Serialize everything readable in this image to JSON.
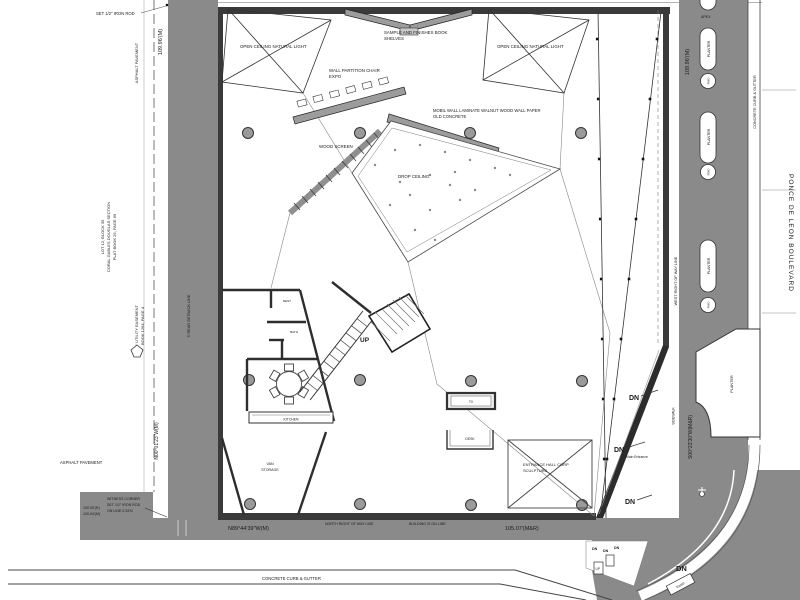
{
  "colors": {
    "paving_gray": "#8a8a8a",
    "wall_dark": "#3a3a3a",
    "wood_gray": "#9c9c9c",
    "line_gray": "#555555",
    "paper_white": "#ffffff"
  },
  "site_west": {
    "iron_rod_note": "SET 1/2\" IRON ROD",
    "dim_north_west": "109.96'(M)",
    "asphalt_vertical": "ASPHALT PAVEMENT",
    "lot_l1": "LOT 12, BLOCK 35",
    "lot_l2": "CORAL GABLES DOUGLAS SECTION",
    "lot_l3": "PLAT BOOK 25, PAGE 69",
    "easement_l1": "5' UTILITY EASEMENT",
    "easement_l2": "BOOK 1264, PAGE 4",
    "rear_setback": "5' REAR SETBACK LINE",
    "asphalt_horizontal": "ASPHALT PAVEMENT",
    "bearing_west": "N00°01'23\"W(M)",
    "witness_l1": "WITNESS CORNER",
    "witness_l2": "SET 1/2\" IRON ROD",
    "witness_l3": "ON LINE 0.33'N",
    "dim_record": "100.00'(R)",
    "dim_measured": "100.04'(M)"
  },
  "site_south": {
    "bearing_south": "N89°44'39\"W(M)",
    "row_line": "NORTH RIGHT OF WAY LINE",
    "building_on_line": "BUILDING IS ON LINE",
    "dim_south": "105.07'(M&R)",
    "curb": "CONCRETE CURB & GUTTER"
  },
  "site_east": {
    "dim_north_east": "109.96'(M)",
    "curb_vertical": "CONCRETE CURB & GUTTER",
    "west_row_line": "WEST RIGHT OF WAY LINE",
    "bearing_east": "S00°23'30\"W(M&R)",
    "sidewalk": "SIDEWALK",
    "street_name": "PONCE DE LEON BOULEVARD",
    "planter_label": "PLANTER",
    "tree_label": "PINO",
    "apex_label": "APEX",
    "dn": "DN",
    "ramp": "RAMP",
    "main_entrance": "Main Entrance",
    "stair_up": "UP"
  },
  "plan": {
    "shelves_l1": "SAMPLE AND FINISHES BOOK",
    "shelves_l2": "SHELVES",
    "open_ceiling": "OPEN CEILING NATURAL LIGHT",
    "partition_l1": "WALL PARTITION CHAIR",
    "partition_l2": "EXPO",
    "mobil_l1": "MOBIL WALL LAMINATE WALNUT WOOD WALL PAPER",
    "mobil_l2": "OLD CONCRETE",
    "wood_screen": "WOOD SCREEN",
    "drop_ceiling": "DROP CEILING",
    "up": "UP",
    "tv": "TV",
    "desk": "DESK",
    "sculpture_l1": "ENTRANCE HALL CORP",
    "sculpture_l2": "SCULPTURE",
    "kitchen": "KITCHEN",
    "van_l1": "VAN",
    "van_l2": "STORAGE",
    "room_a": "REST",
    "room_b": "BATH"
  }
}
